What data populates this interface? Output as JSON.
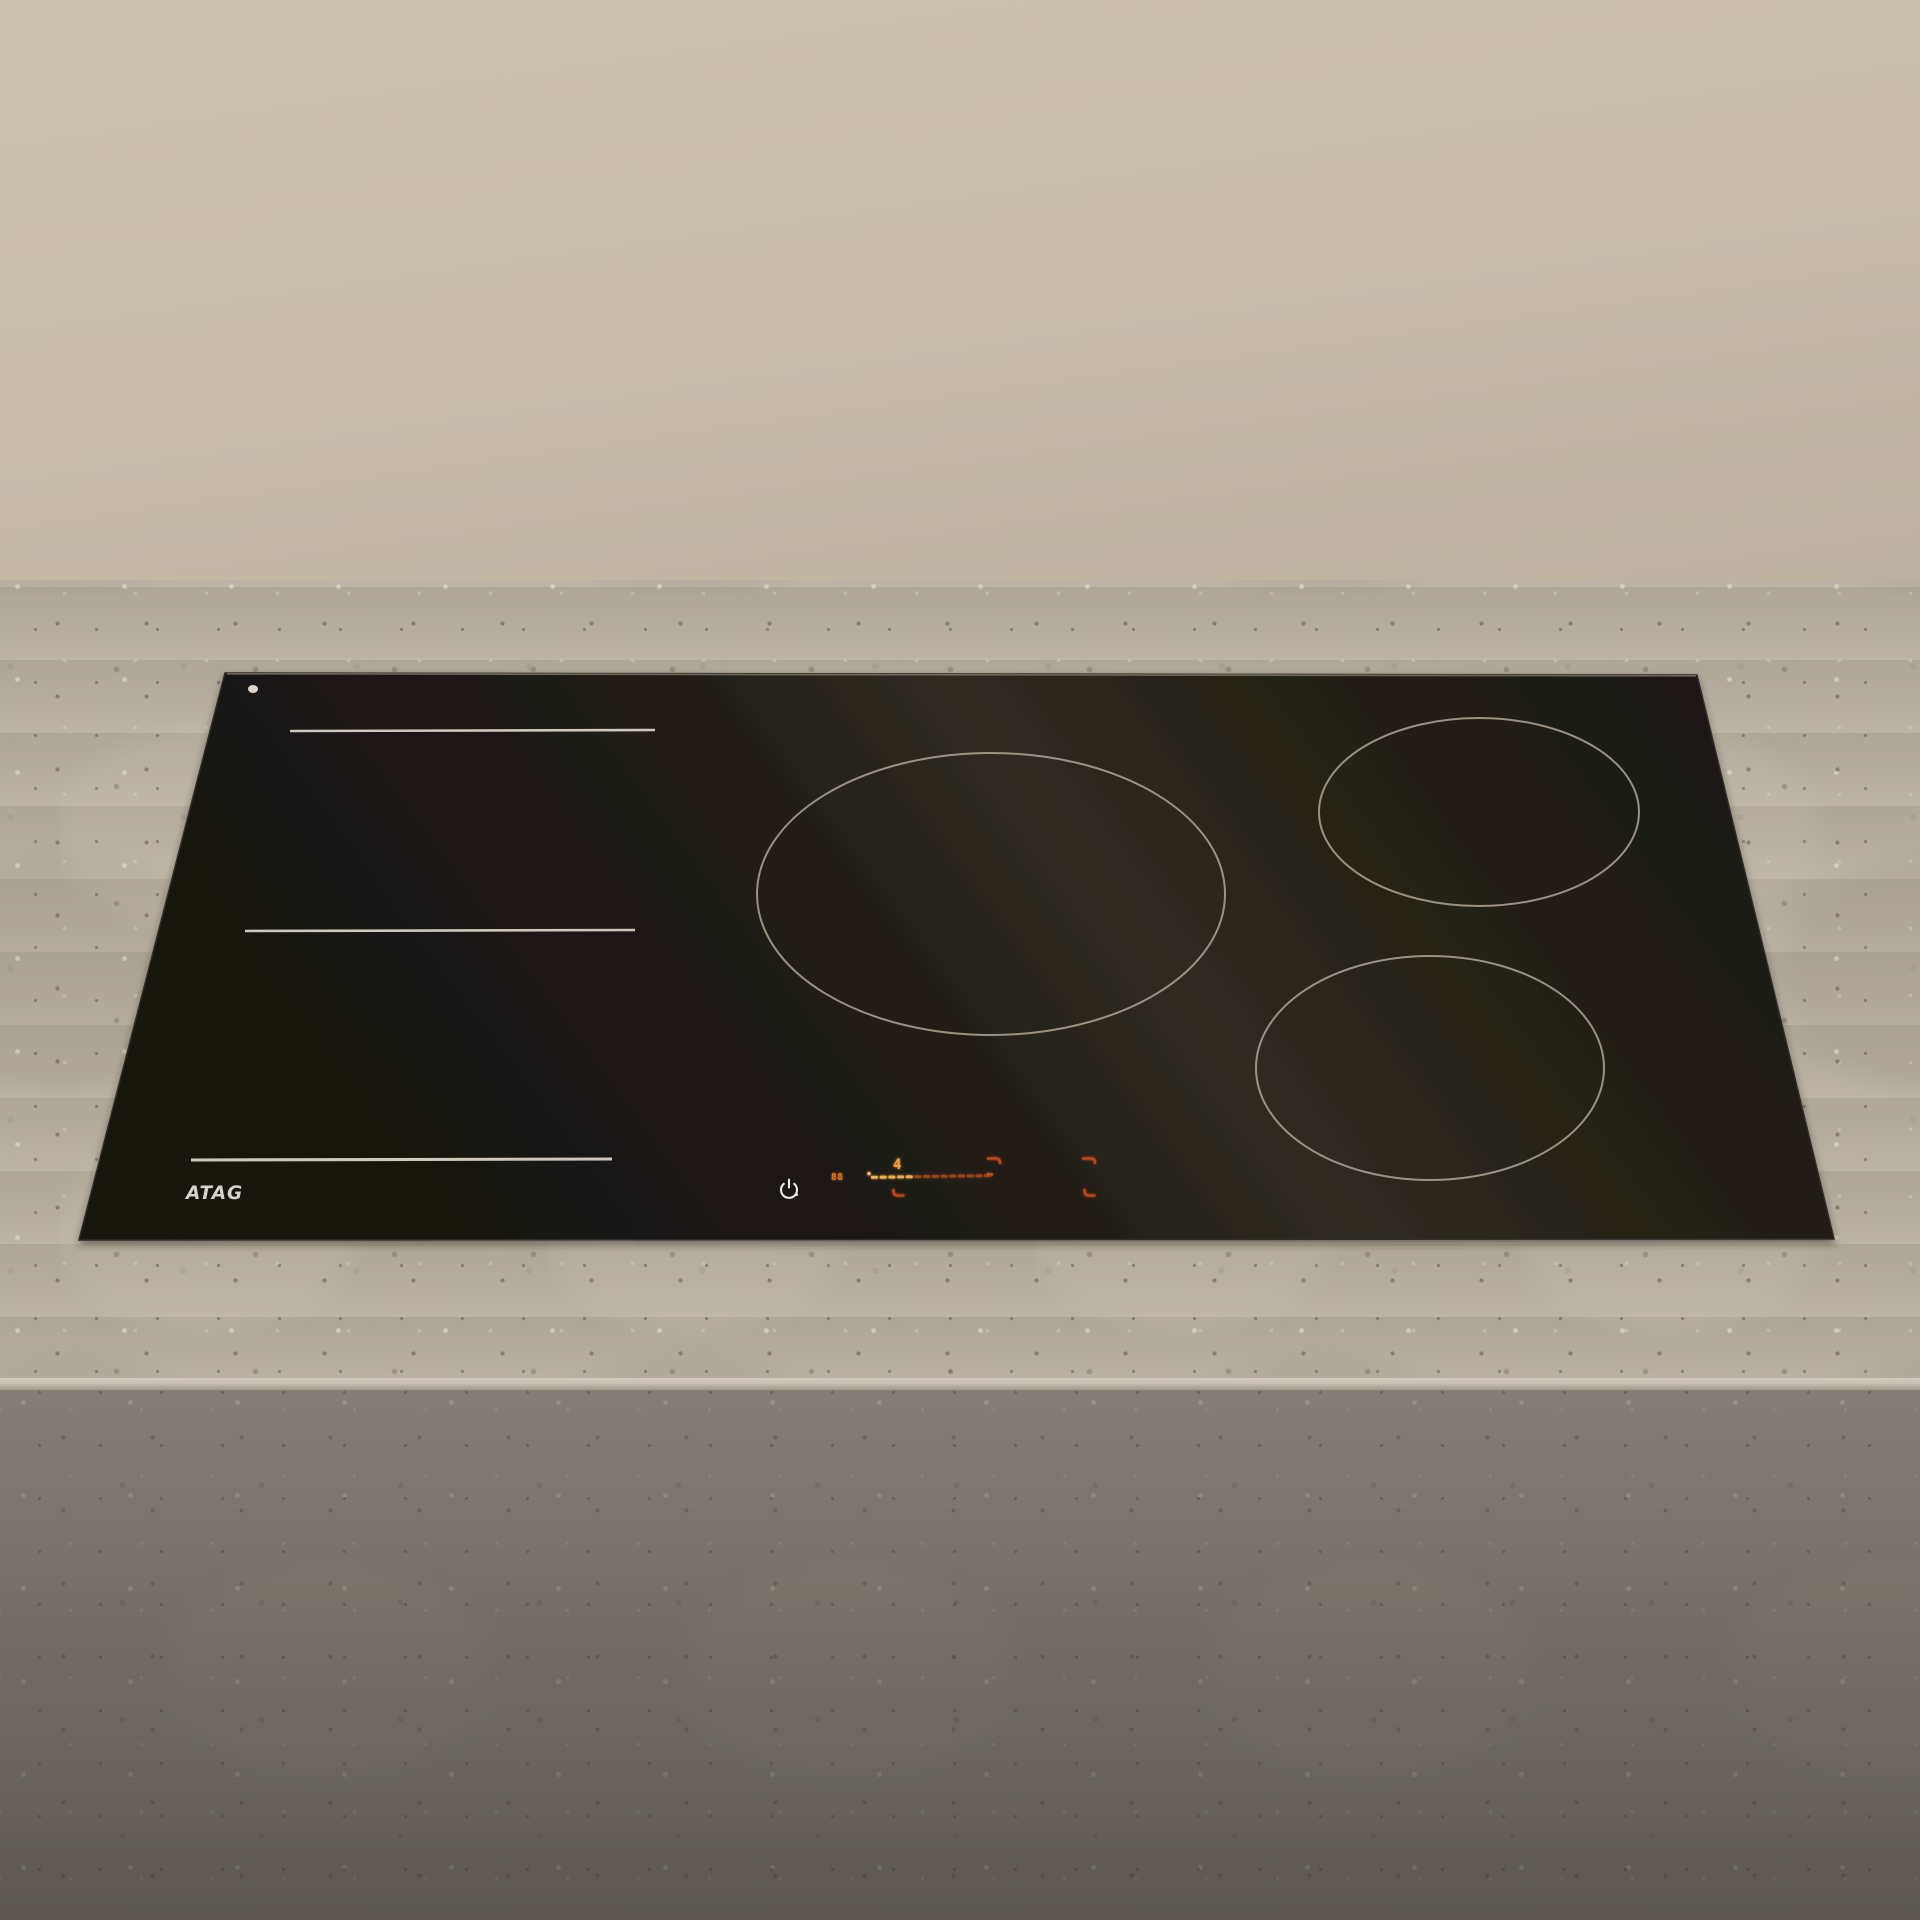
{
  "product": {
    "brand": "ATAG",
    "category": "induction-hob"
  },
  "hob": {
    "brand": "ATAG",
    "indicator_dot": "on",
    "zones": {
      "flex_zone_lines": 3,
      "round_zones": 3
    },
    "controls": {
      "power_button_icon": "power-icon",
      "timer_display": "88",
      "power_level": "4",
      "touch_zone_markers": 2,
      "slider": {
        "segments": 14,
        "lit_segments": 5,
        "lit_color": "#f2ad4e",
        "dim_color": "#a34315",
        "start_dot_color": "#f7bd62",
        "end_dot_color": "#d4672a"
      },
      "bracket_color": "#bf4717"
    },
    "colors": {
      "glass": "#1d1915",
      "glass_sheen": "#2f2a22",
      "zone_ring": "#a89e8e",
      "flex_line": "#d8d2c5",
      "logo": "#d6d2ca",
      "power_icon": "#eceade",
      "display_orange": "#f5a03c",
      "timer_orange": "#e0761f"
    }
  },
  "scene": {
    "wall_color": "#c8bdab",
    "countertop_color": "#b3ac9f",
    "countertop_front_color": "#857f77"
  }
}
